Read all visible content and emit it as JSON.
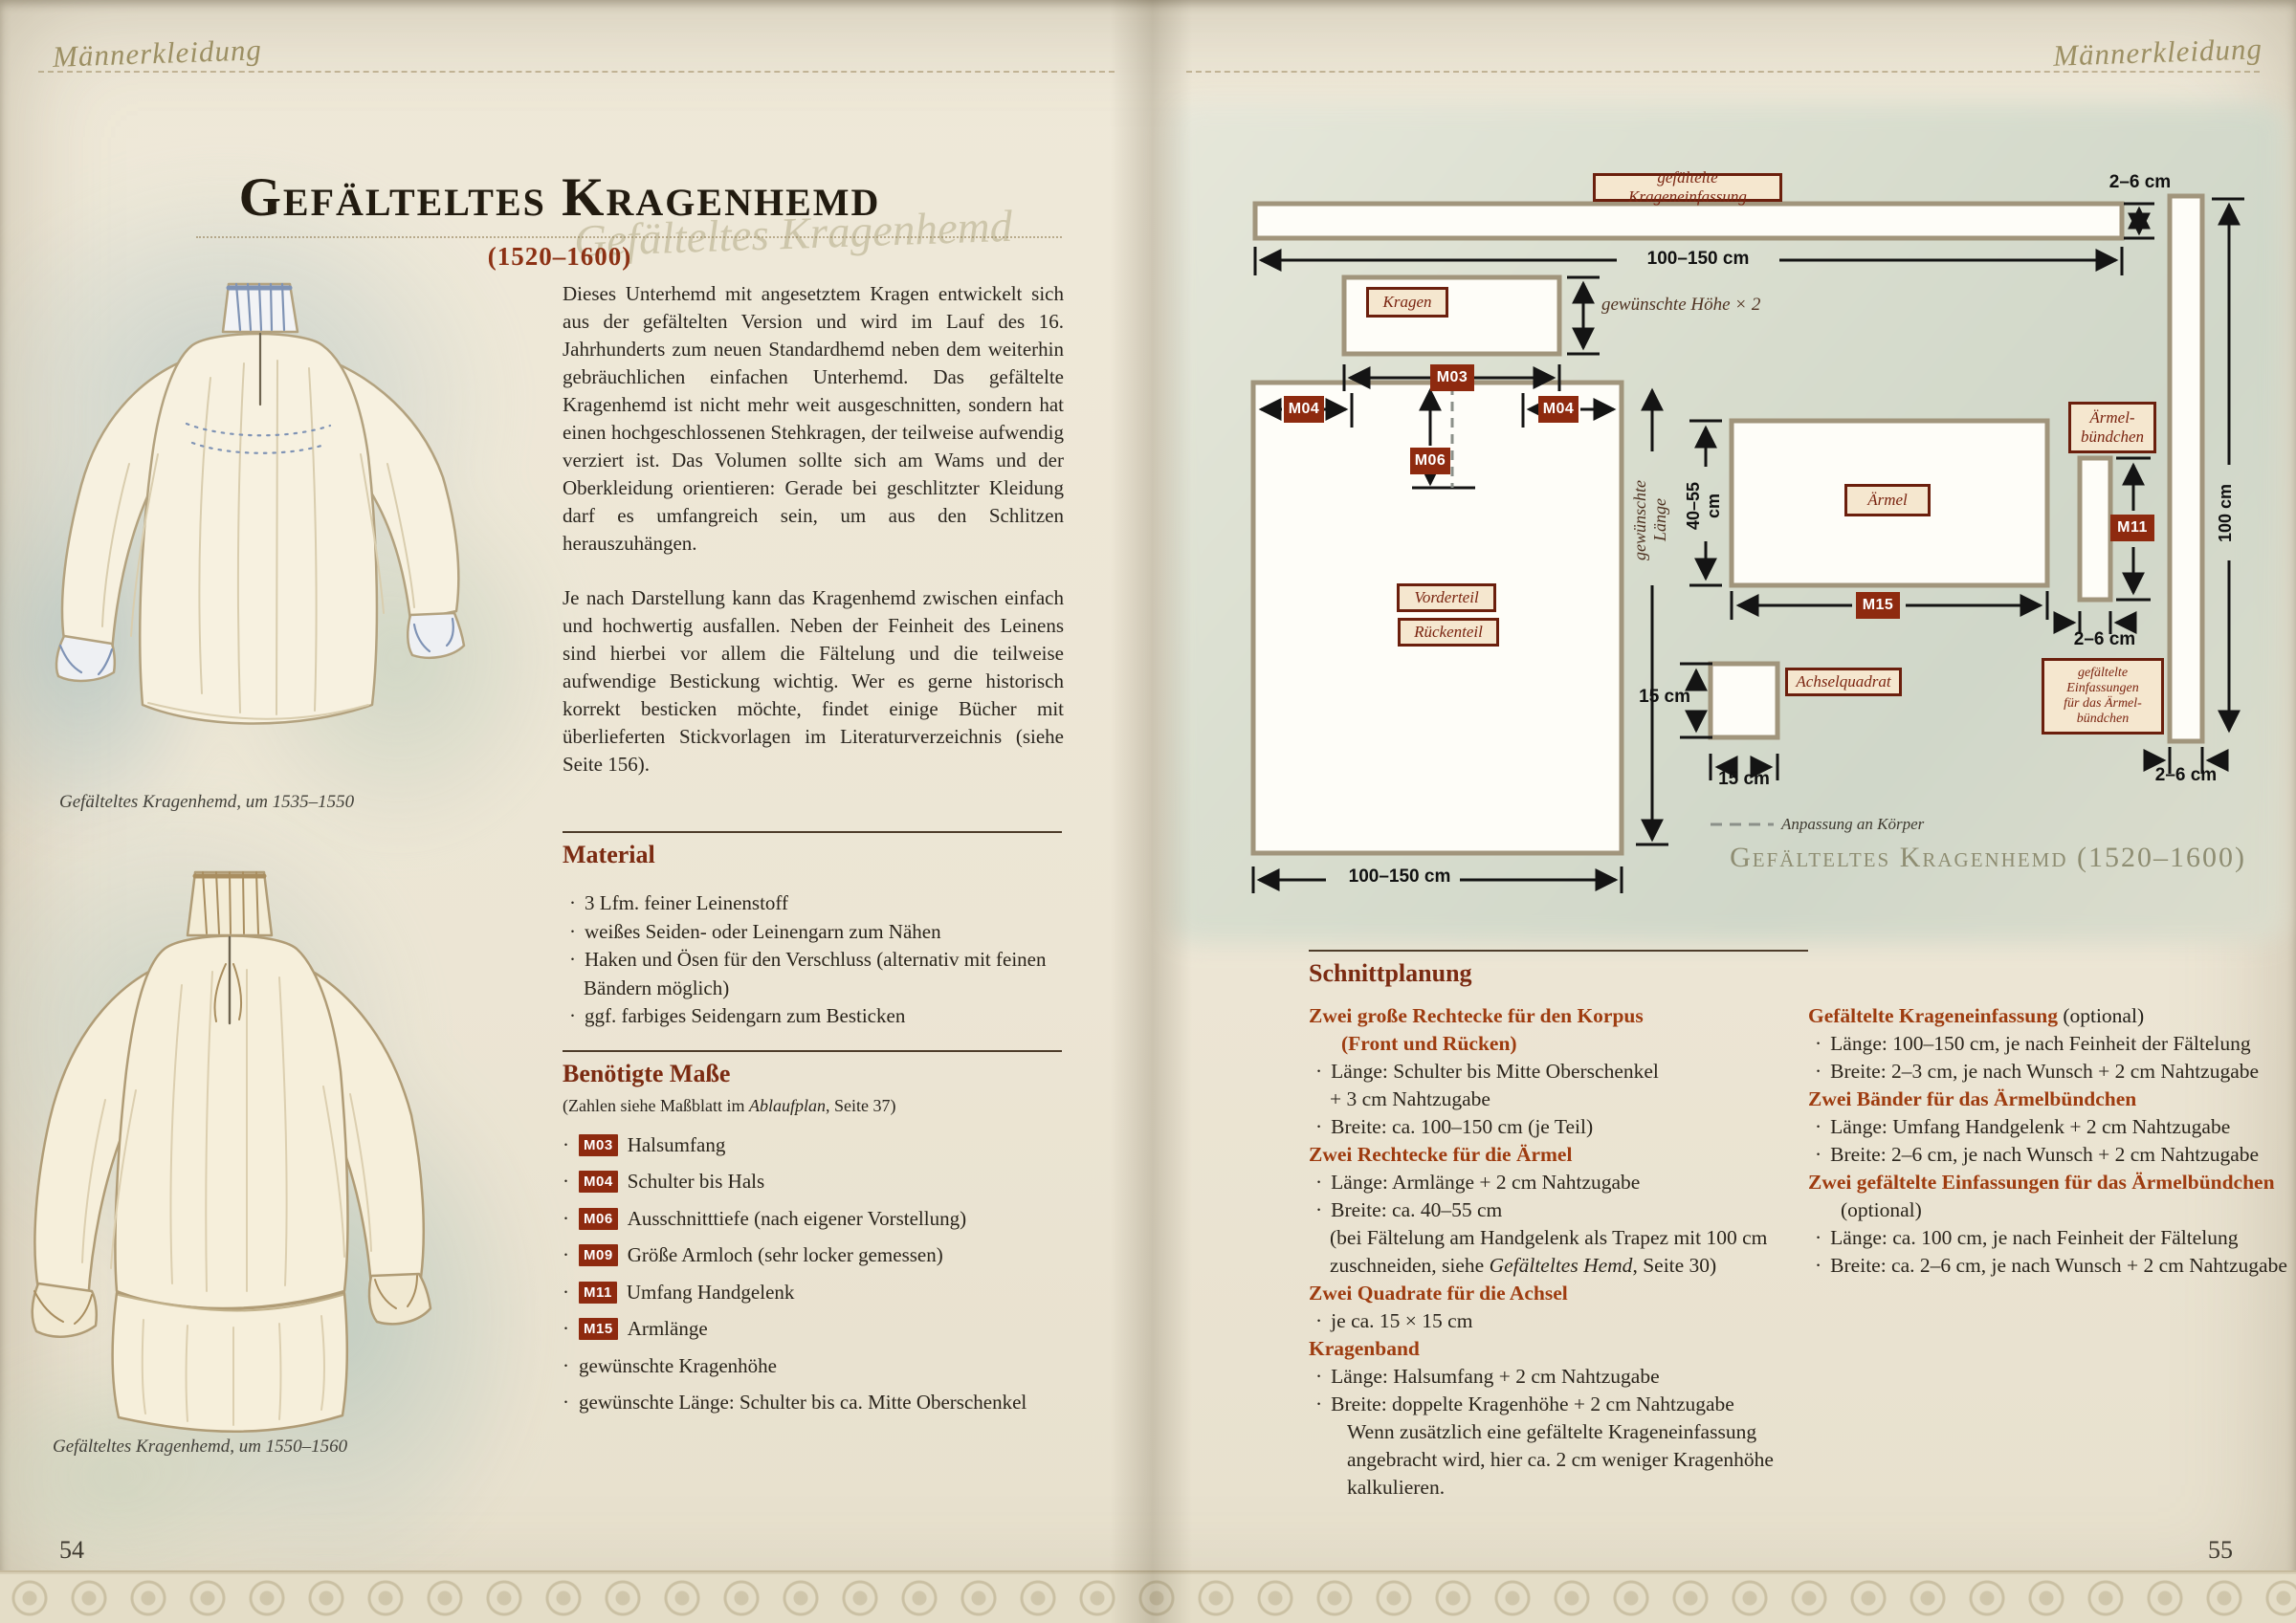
{
  "header": {
    "left_script": "Männerkleidung",
    "right_script": "Männerkleidung"
  },
  "left_page": {
    "title": "Gefälteltes Kragenhemd",
    "subtitle": "(1520–1600)",
    "ghost_script": "Gefälteltes Kragenhemd",
    "intro_paragraph_1": "Dieses Unterhemd mit angesetztem Kragen entwickelt sich aus der gefältelten Version und wird im Lauf des 16. Jahrhunderts zum neuen Standardhemd neben dem weiterhin gebräuchlichen einfachen Unterhemd. Das gefältelte Kragenhemd ist nicht mehr weit ausgeschnitten, sondern hat einen hochgeschlossenen Stehkragen, der teilweise aufwendig verziert ist. Das Volumen sollte sich am Wams und der Oberkleidung orientieren: Gerade bei geschlitzter Kleidung darf es umfangreich sein, um aus den Schlitzen herauszuhängen.",
    "intro_paragraph_2": "Je nach Darstellung kann das Kragenhemd zwischen einfach und hochwertig ausfallen. Neben der Feinheit des Leinens sind hierbei vor allem die Fältelung und die teilweise aufwendige Bestickung wichtig. Wer es gerne historisch korrekt besticken möchte, findet einige Bücher mit überlieferten Stickvorlagen im Literaturverzeichnis (siehe Seite 156).",
    "caption_1": "Gefälteltes Kragenhemd, um 1535–1550",
    "caption_2": "Gefälteltes Kragenhemd, um 1550–1560",
    "material": {
      "heading": "Material",
      "items": [
        "3 Lfm. feiner Leinenstoff",
        "weißes Seiden- oder Leinengarn zum Nähen",
        "Haken und Ösen für den Verschluss (alternativ mit feinen Bändern möglich)",
        "ggf. farbiges Seidengarn zum Besticken"
      ]
    },
    "measures": {
      "heading": "Benötigte Maße",
      "note_pre": "(Zahlen siehe Maßblatt im ",
      "note_italic": "Ablaufplan",
      "note_post": ", Seite 37)",
      "items": [
        {
          "code": "M03",
          "label": "Halsumfang"
        },
        {
          "code": "M04",
          "label": "Schulter bis Hals"
        },
        {
          "code": "M06",
          "label": "Ausschnitttiefe (nach eigener Vorstellung)"
        },
        {
          "code": "M09",
          "label": "Größe Armloch (sehr locker gemessen)"
        },
        {
          "code": "M11",
          "label": "Umfang Handgelenk"
        },
        {
          "code": "M15",
          "label": "Armlänge"
        },
        {
          "code": "",
          "label": "gewünschte Kragenhöhe"
        },
        {
          "code": "",
          "label": "gewünschte Länge: Schulter bis ca. Mitte Oberschenkel"
        }
      ]
    },
    "page_number": "54"
  },
  "right_page": {
    "diagram": {
      "einfassung_label": "gefältelte Krageneinfassung",
      "top_height": "2–6 cm",
      "top_width": "100–150 cm",
      "kragen_label": "Kragen",
      "kragen_height_note": "gewünschte Höhe × 2",
      "m_halsumfang": "M03",
      "m_schulter_links": "M04",
      "m_schulter_rechts": "M04",
      "m_ausschnitt": "M06",
      "vorderteil_label": "Vorderteil",
      "rueckenteil_label": "Rückenteil",
      "laenge_note": "gewünschte Länge",
      "body_width": "100–150 cm",
      "aermel_label": "Ärmel",
      "aermel_breite": "40–55 cm",
      "m_armlaenge": "M15",
      "buendchen_line1": "Ärmel-",
      "buendchen_line2": "bündchen",
      "m_handgelenk": "M11",
      "buendchen_breite": "2–6 cm",
      "achsel_label": "Achselquadrat",
      "achsel_hoehe": "15 cm",
      "achsel_breite": "15 cm",
      "streifen_laenge": "100 cm",
      "streifen_breite": "2–6 cm",
      "einfassung2_line1": "gefältelte",
      "einfassung2_line2": "Einfassungen",
      "einfassung2_line3": "für das Ärmel-",
      "einfassung2_line4": "bündchen",
      "legend": "Anpassung an Körper",
      "caption": "Gefälteltes Kragenhemd (1520–1600)"
    },
    "cutting": {
      "heading": "Schnittplanung",
      "left": {
        "h1a": "Zwei große Rechtecke für den Korpus",
        "h1b": "(Front und Rücken)",
        "b1a1": "Länge: Schulter bis Mitte Oberschenkel",
        "b1a2": "+ 3 cm Nahtzugabe",
        "b1b": "Breite: ca. 100–150 cm (je Teil)",
        "h2": "Zwei Rechtecke für die Ärmel",
        "b2a": "Länge: Armlänge + 2 cm Nahtzugabe",
        "b2b": "Breite: ca. 40–55 cm",
        "b2c1": "(bei Fältelung am Handgelenk als Trapez mit 100 cm",
        "b2c2_pre": "zuschneiden, siehe ",
        "b2c2_italic": "Gefälteltes Hemd",
        "b2c2_post": ", Seite 30)",
        "h3": "Zwei Quadrate für die Achsel",
        "b3a": "je ca. 15 × 15 cm",
        "h4": "Kragenband",
        "b4a": "Länge: Halsumfang + 2 cm Nahtzugabe",
        "b4b": "Breite: doppelte Kragenhöhe + 2 cm Nahtzugabe",
        "b4c1": "Wenn zusätzlich eine gefältelte Krageneinfassung",
        "b4c2": "angebracht wird, hier ca. 2 cm weniger Kragenhöhe",
        "b4c3": "kalkulieren."
      },
      "right": {
        "h1": "Gefältelte Krageneinfassung",
        "h1_suffix": " (optional)",
        "b1a": "Länge: 100–150 cm, je nach Feinheit der Fältelung",
        "b1b": "Breite: 2–3 cm, je nach Wunsch + 2 cm Nahtzugabe",
        "h2": "Zwei Bänder für das Ärmelbündchen",
        "b2a": "Länge: Umfang Handgelenk + 2 cm Nahtzugabe",
        "b2b": "Breite: 2–6 cm, je nach Wunsch + 2 cm Nahtzugabe",
        "h3": "Zwei gefältelte Einfassungen für das Ärmelbündchen",
        "h3b": "(optional)",
        "b3a": "Länge: ca. 100 cm, je nach Feinheit der Fältelung",
        "b3b": "Breite: ca. 2–6 cm, je nach Wunsch + 2 cm Nahtzugabe"
      }
    },
    "page_number": "55"
  }
}
